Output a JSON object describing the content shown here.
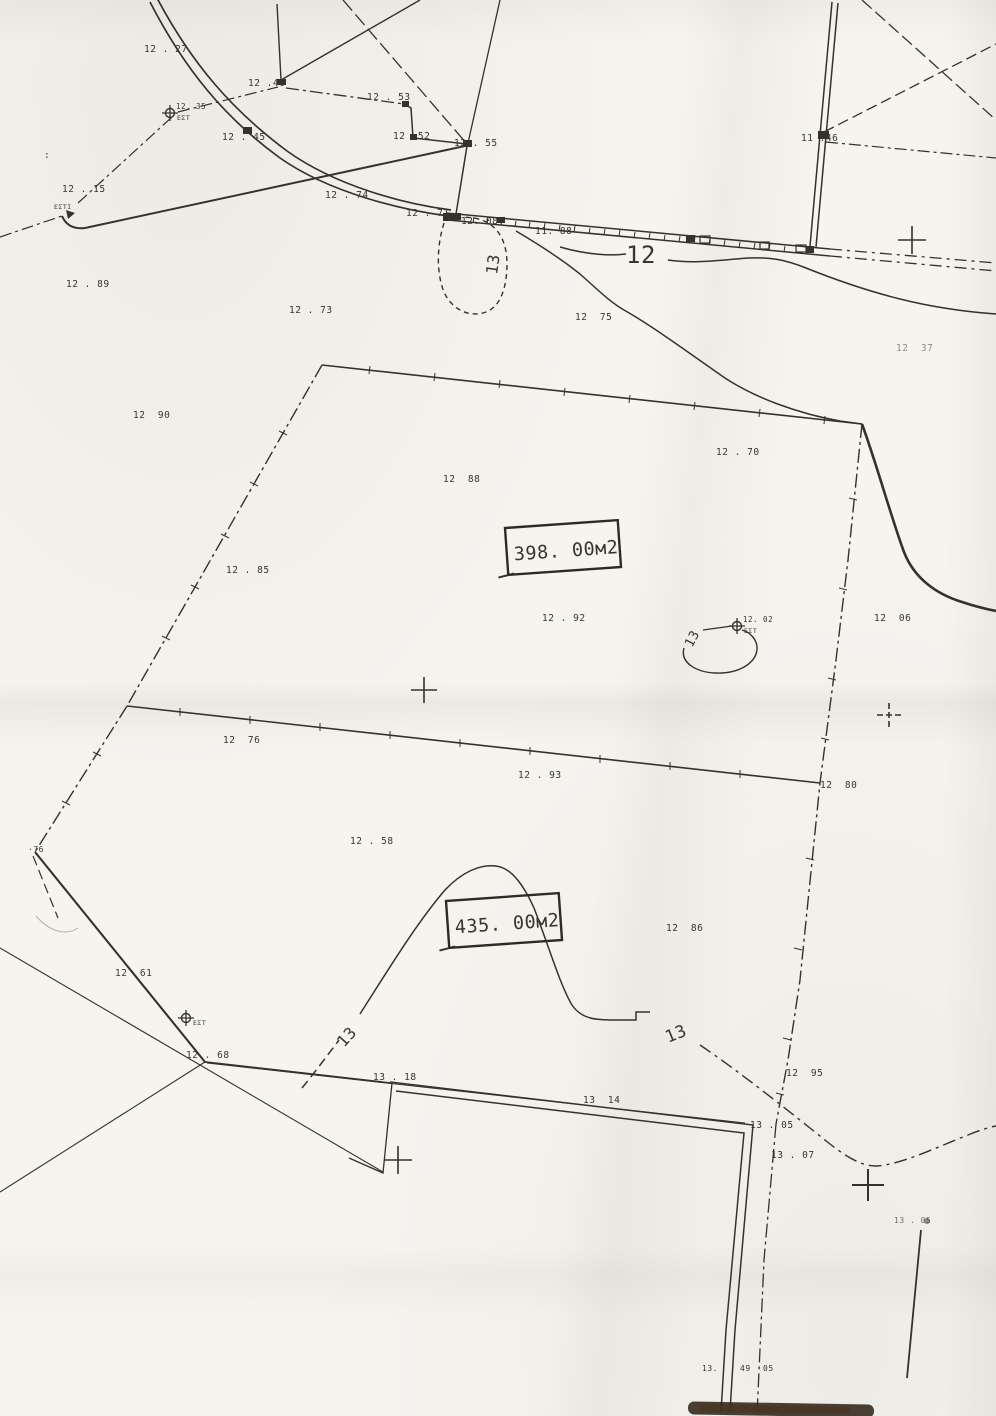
{
  "document": {
    "kind": "scanned cadastral survey sketch",
    "units_label": "м2",
    "ink_color": "#35322c",
    "paper_color": "#f6f4ef"
  },
  "areas": [
    {
      "value": "398. 00м2"
    },
    {
      "value": "435. 00м2"
    }
  ],
  "labels": [
    {
      "t": "12 . 27",
      "x": 144,
      "y": 52
    },
    {
      "t": "12 .46",
      "x": 248,
      "y": 86
    },
    {
      "t": "12 . 53",
      "x": 367,
      "y": 100
    },
    {
      "t": "12 .52",
      "x": 393,
      "y": 139
    },
    {
      "t": "12 . 55",
      "x": 454,
      "y": 146
    },
    {
      "t": "12 . 45",
      "x": 222,
      "y": 140
    },
    {
      "t": "12 . 15",
      "x": 62,
      "y": 192
    },
    {
      "t": "ΕΣΤΙ",
      "x": 54,
      "y": 209,
      "s": 6.5
    },
    {
      "t": ":",
      "x": 44,
      "y": 158
    },
    {
      "t": "12 . 74",
      "x": 325,
      "y": 198
    },
    {
      "t": "12 . 71",
      "x": 406,
      "y": 216
    },
    {
      "t": "12. 08",
      "x": 461,
      "y": 224
    },
    {
      "t": "11. 88",
      "x": 535,
      "y": 234
    },
    {
      "t": "11 .46",
      "x": 801,
      "y": 141
    },
    {
      "t": "12 . 89",
      "x": 66,
      "y": 287
    },
    {
      "t": "12 . 73",
      "x": 289,
      "y": 313
    },
    {
      "t": "12  75",
      "x": 575,
      "y": 320
    },
    {
      "t": "12  37",
      "x": 896,
      "y": 351,
      "o": 0.55
    },
    {
      "t": "12  90",
      "x": 133,
      "y": 418
    },
    {
      "t": "12 . 70",
      "x": 716,
      "y": 455
    },
    {
      "t": "12  88",
      "x": 443,
      "y": 482
    },
    {
      "t": "12 . 85",
      "x": 226,
      "y": 573
    },
    {
      "t": "12 . 92",
      "x": 542,
      "y": 621
    },
    {
      "t": "12  06",
      "x": 874,
      "y": 621
    },
    {
      "t": "12  76",
      "x": 223,
      "y": 743
    },
    {
      "t": "12 . 93",
      "x": 518,
      "y": 778
    },
    {
      "t": "12  80",
      "x": 820,
      "y": 788
    },
    {
      "t": "12 . 58",
      "x": 350,
      "y": 844
    },
    {
      "t": "·76",
      "x": 28,
      "y": 852,
      "s": 8
    },
    {
      "t": "12  86",
      "x": 666,
      "y": 931
    },
    {
      "t": "12  61",
      "x": 115,
      "y": 976
    },
    {
      "t": "12 . 68",
      "x": 186,
      "y": 1058
    },
    {
      "t": "13 . 18",
      "x": 373,
      "y": 1080
    },
    {
      "t": "13  14",
      "x": 583,
      "y": 1103
    },
    {
      "t": "12  95",
      "x": 786,
      "y": 1076
    },
    {
      "t": "13 . 05",
      "x": 750,
      "y": 1128
    },
    {
      "t": "13 . 07",
      "x": 771,
      "y": 1158
    },
    {
      "t": "13 . 05",
      "x": 894,
      "y": 1223,
      "s": 8,
      "o": 0.7
    },
    {
      "t": "13.",
      "x": 702,
      "y": 1371,
      "s": 8
    },
    {
      "t": "49",
      "x": 740,
      "y": 1371,
      "s": 8
    },
    {
      "t": "05",
      "x": 763,
      "y": 1371,
      "s": 8
    }
  ],
  "contour_labels": [
    {
      "t": "13",
      "x": 497,
      "y": 275,
      "rot": -82,
      "s": 16
    },
    {
      "t": "12",
      "x": 626,
      "y": 263,
      "s": 24,
      "sp": 7
    },
    {
      "t": "13",
      "x": 692,
      "y": 648,
      "rot": -62,
      "s": 13
    },
    {
      "t": "13",
      "x": 344,
      "y": 1048,
      "rot": -48,
      "s": 16
    },
    {
      "t": "13",
      "x": 668,
      "y": 1043,
      "rot": -22,
      "s": 17
    }
  ],
  "benchmarks": [
    {
      "x": 170,
      "y": 113,
      "top": "12. 35",
      "bot": "ΕΣΤ"
    },
    {
      "x": 737,
      "y": 626,
      "top": "12. 02",
      "bot": "ΕΣΤ"
    },
    {
      "x": 186,
      "y": 1018,
      "top": "",
      "bot": "ΕΣΤ"
    }
  ],
  "crosses": [
    {
      "x": 912,
      "y": 240,
      "a": 14
    },
    {
      "x": 424,
      "y": 690,
      "a": 13
    },
    {
      "x": 889,
      "y": 715,
      "a": 12,
      "dash": true
    },
    {
      "x": 398,
      "y": 1160,
      "a": 14
    },
    {
      "x": 868,
      "y": 1185,
      "a": 16,
      "w": 2
    }
  ]
}
